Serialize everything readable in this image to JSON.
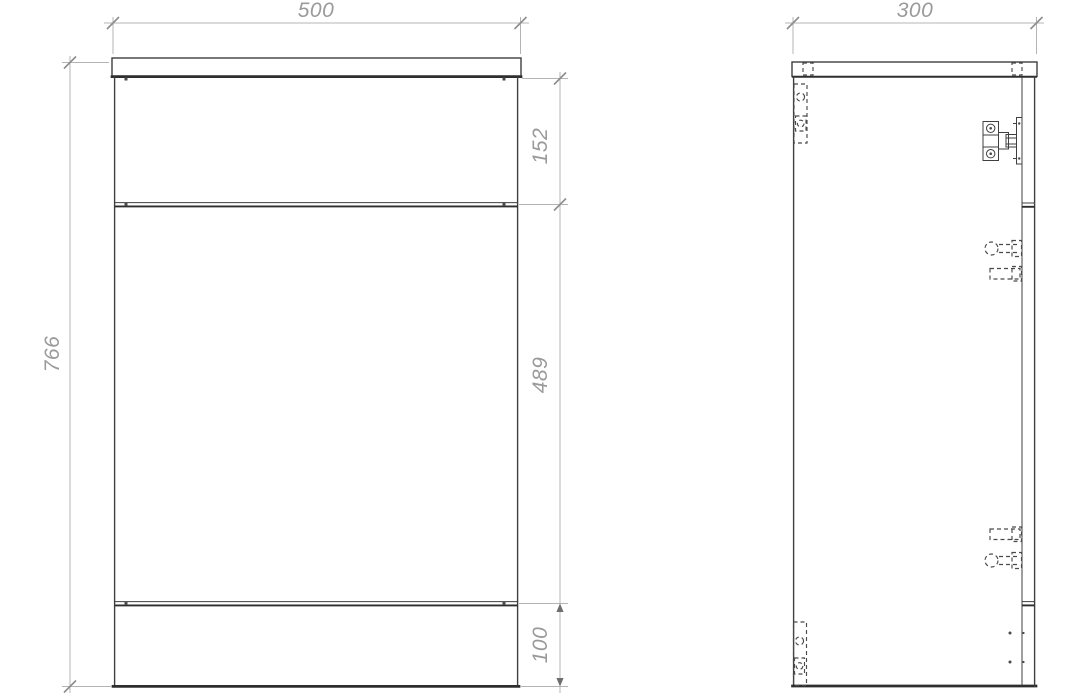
{
  "drawing": {
    "front_view": {
      "width": "500",
      "height": "766",
      "top_section_height": "152",
      "middle_section_height": "489",
      "bottom_section_height": "100"
    },
    "side_view": {
      "depth": "300"
    },
    "colors": {
      "background": "#ffffff",
      "outline": "#3f3f3f",
      "outline_heavy": "#2e2e2e",
      "dimension_line": "#b4b4b4",
      "dimension_text": "#9a9a9a",
      "hidden_detail": "#4a4a4a"
    }
  }
}
